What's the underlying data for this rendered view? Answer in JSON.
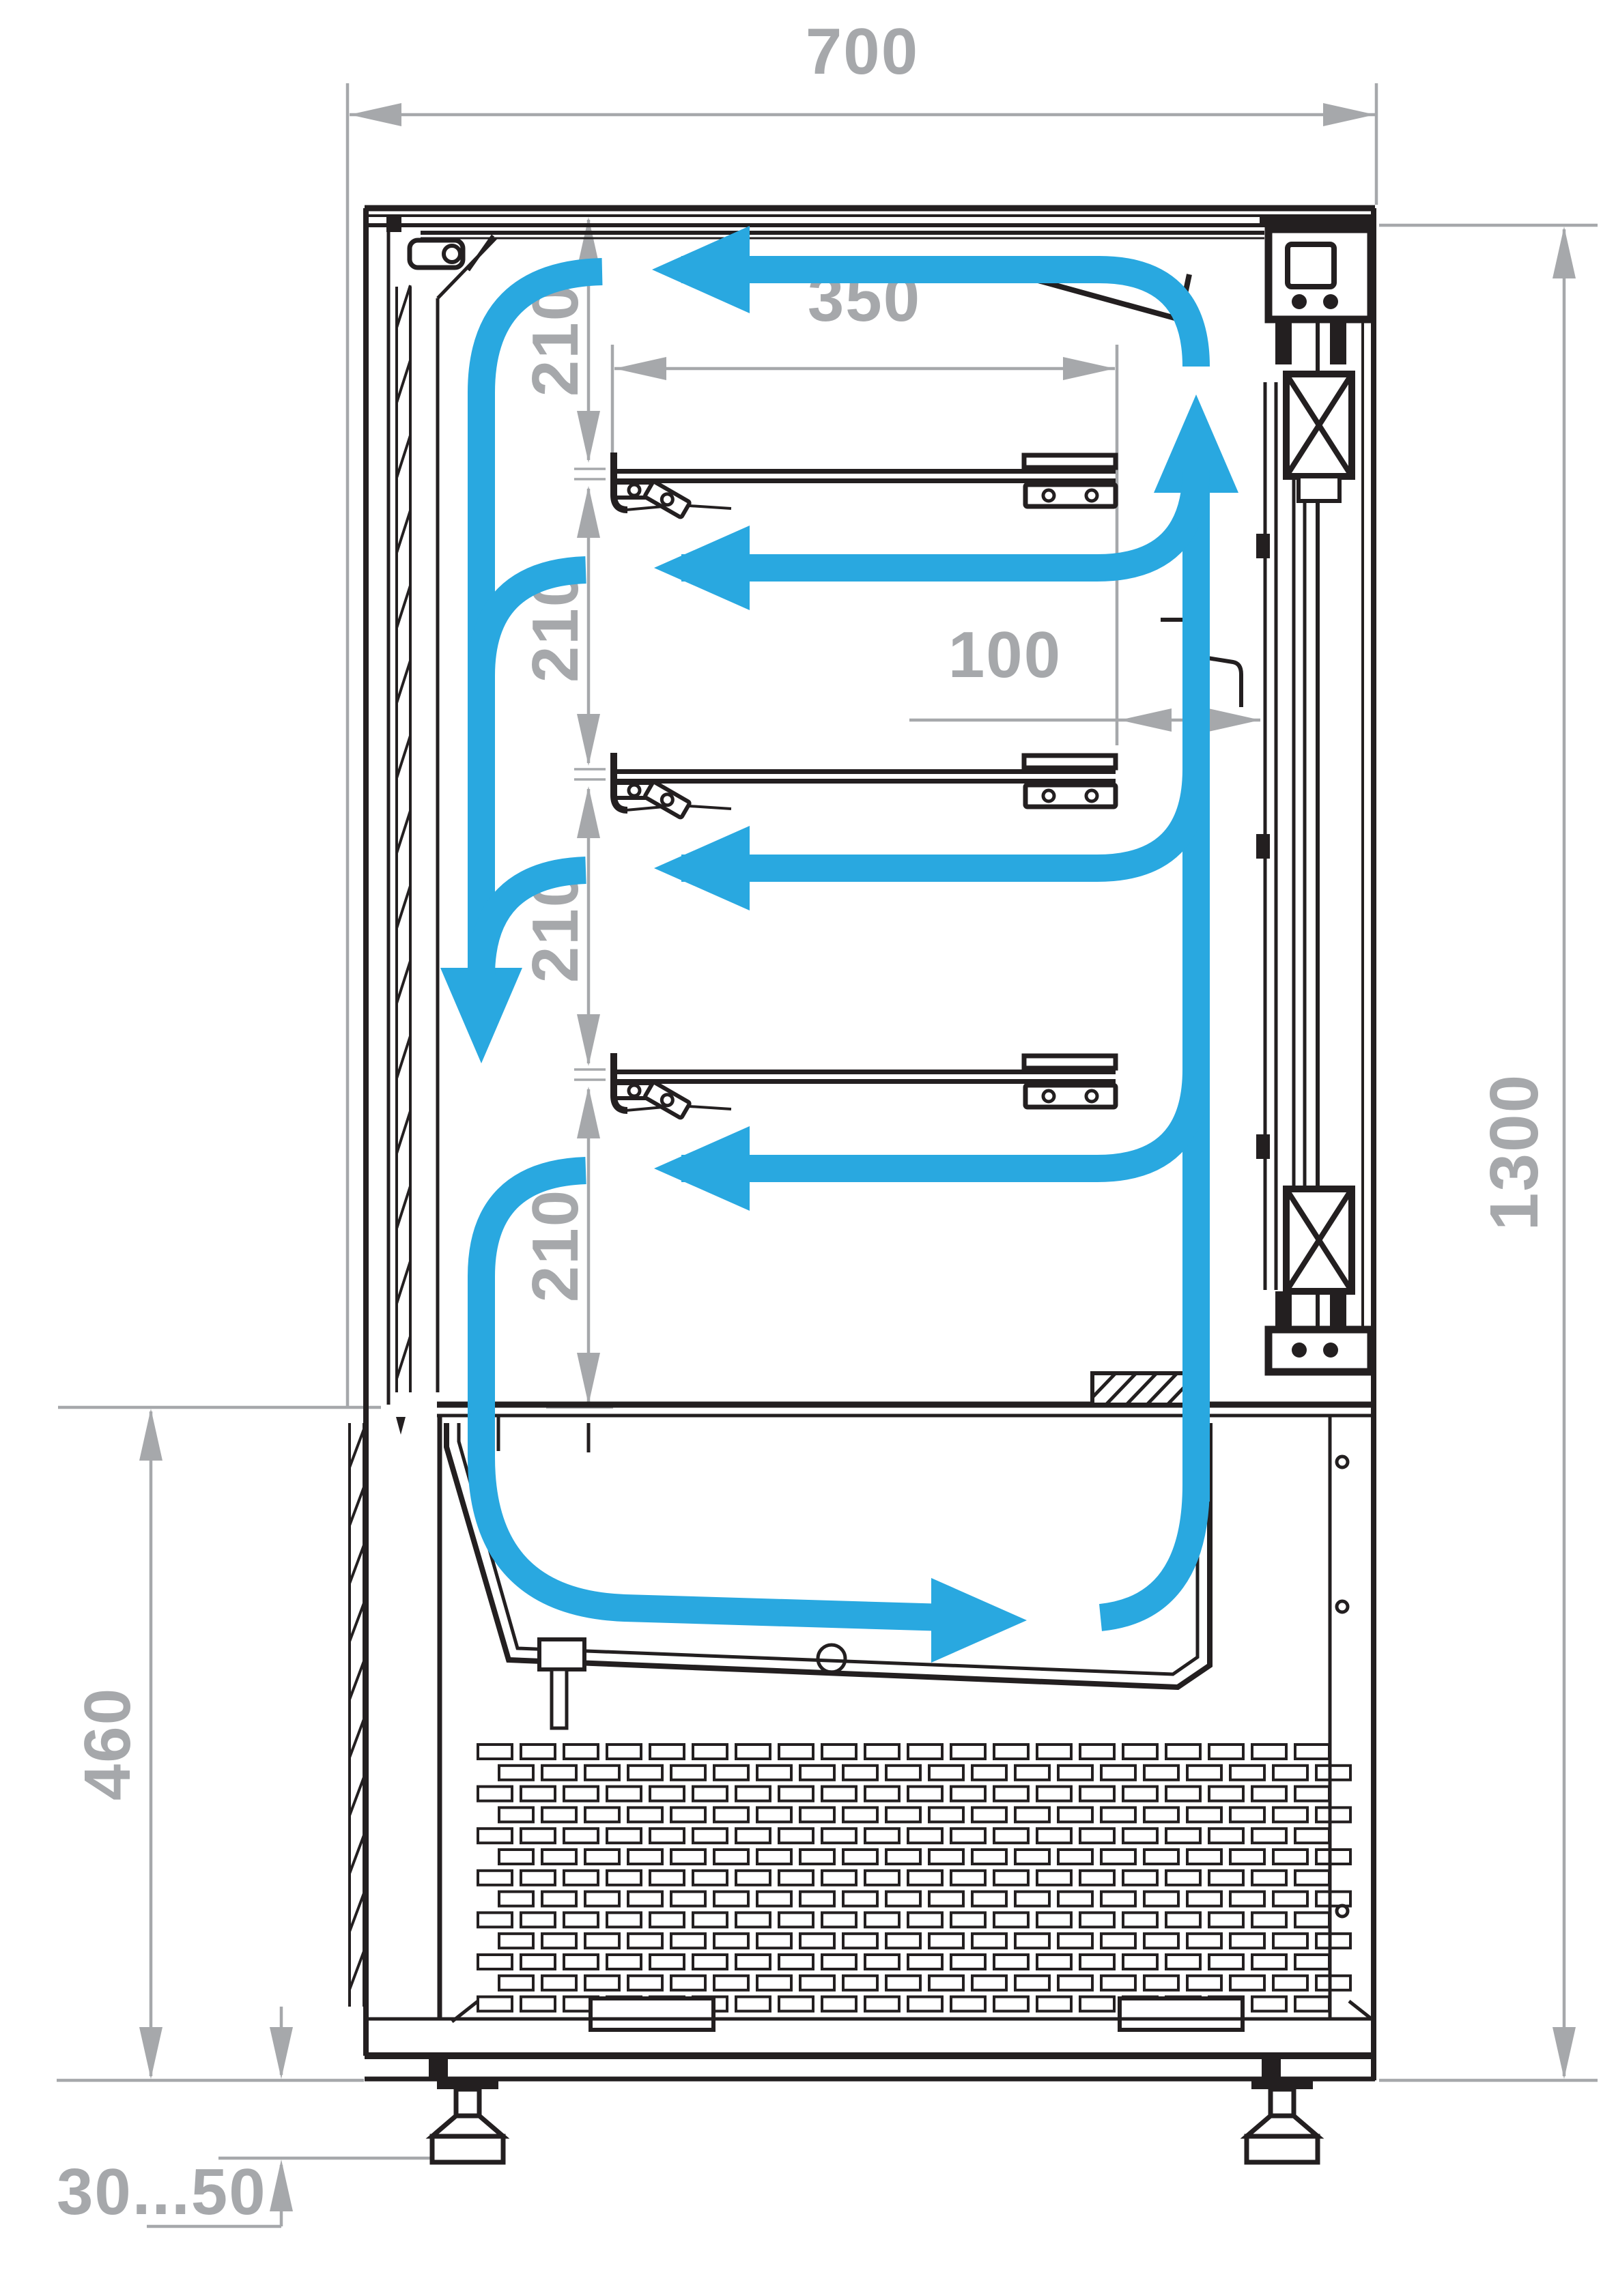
{
  "title": "Refrigerated display case cross-section with air circulation",
  "colors": {
    "airflow_blue": "#29A8E0",
    "dimension_gray": "#A6A8AB",
    "line_black": "#231F20",
    "background": "#FFFFFF"
  },
  "dimensions": {
    "overall_width_mm": "700",
    "shelf_depth_mm": "350",
    "front_gap_mm": "100",
    "shelf_spacing_mm": "210",
    "display_height_mm": "1300",
    "base_height_mm": "460",
    "foot_height_range_mm": "30...50"
  }
}
